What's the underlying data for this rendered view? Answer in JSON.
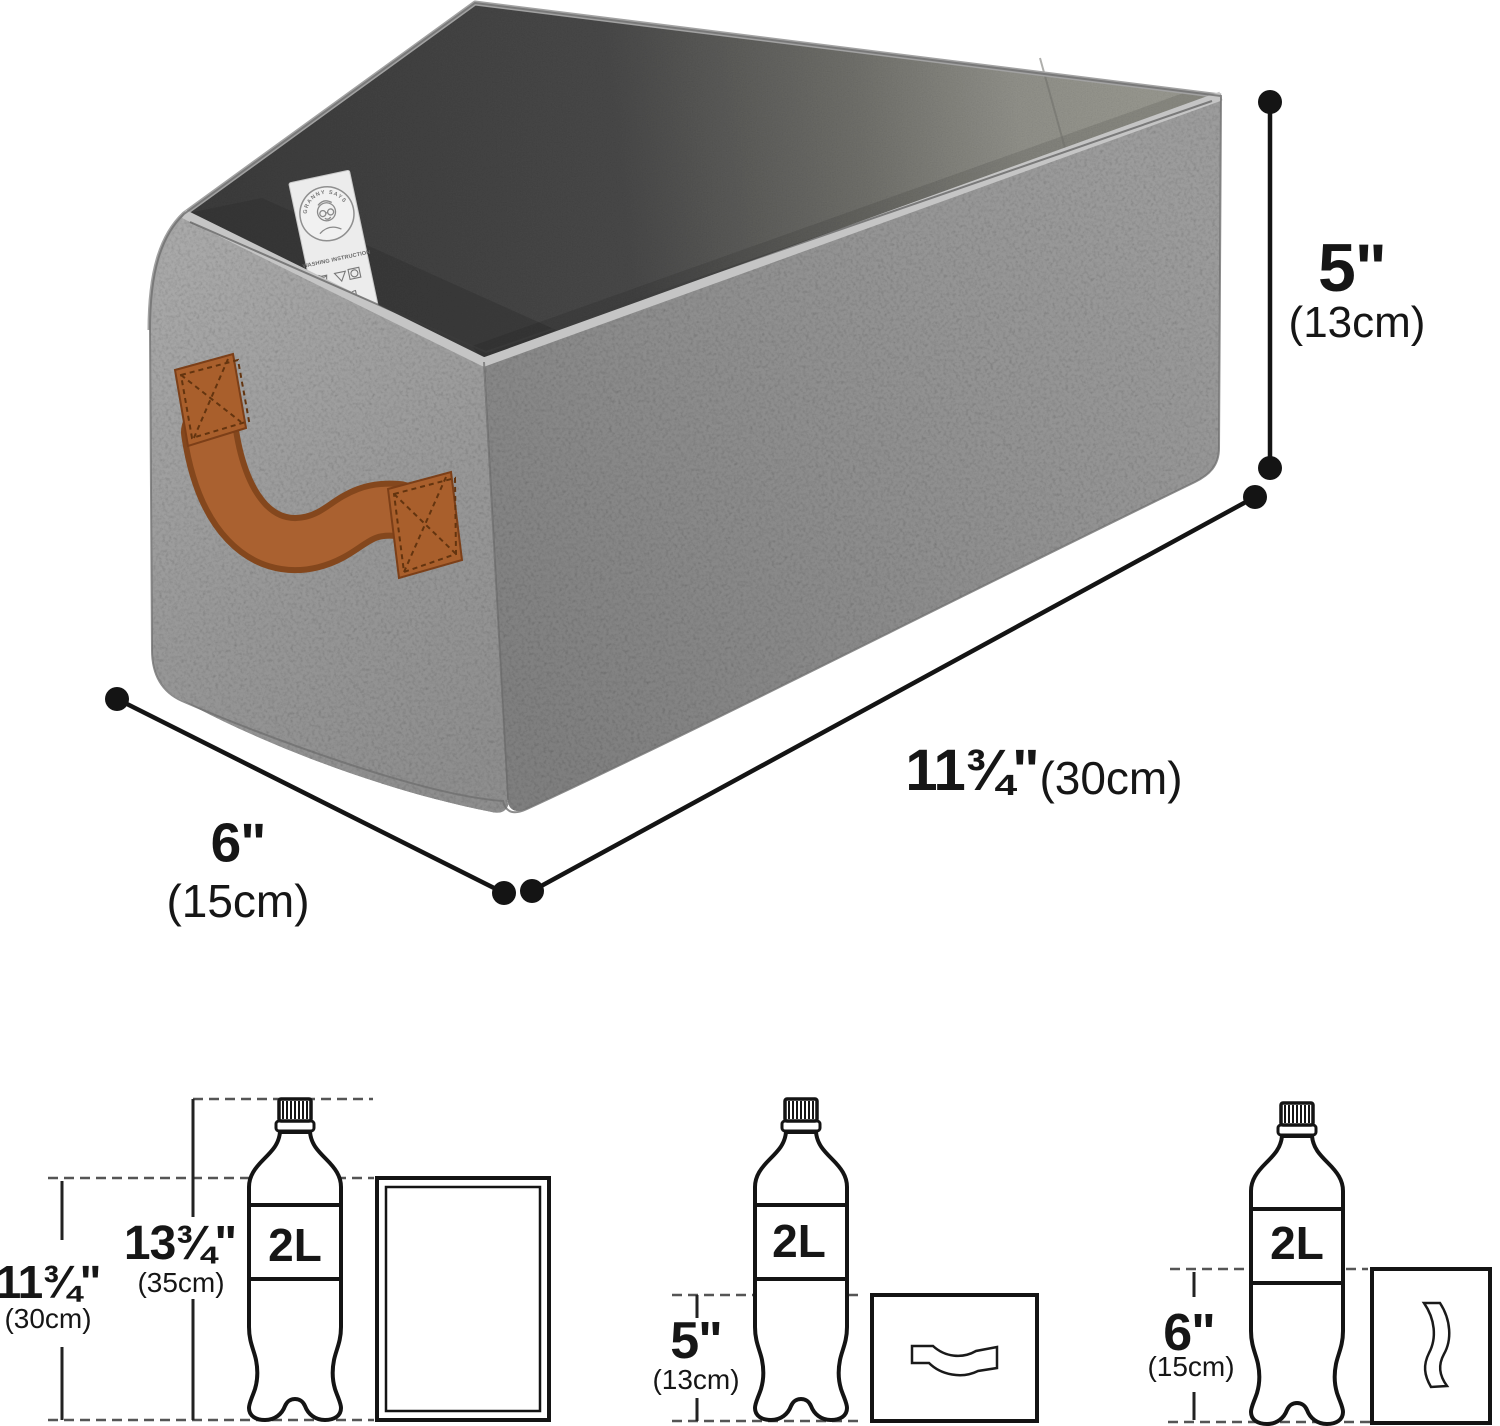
{
  "image_type": "storage-bin-dimension-diagram",
  "brand_tag": {
    "brand": "GRANNY SAYS",
    "text": "WASHING INSTRUCTION"
  },
  "main_dimensions": {
    "height_in": "5\"",
    "height_cm": "(13cm)",
    "length_in": "11¾\"",
    "length_cm": "(30cm)",
    "width_in": "6\"",
    "width_cm": "(15cm)"
  },
  "folded": {
    "panel": {
      "bottle": "2L",
      "height_in": "11¾\"",
      "height_cm": "(30cm)",
      "bottle_height_in": "13¾\"",
      "bottle_height_cm": "(35cm)"
    },
    "flat": {
      "bottle": "2L",
      "height_in": "5\"",
      "height_cm": "(13cm)"
    },
    "side": {
      "bottle": "2L",
      "height_in": "6\"",
      "height_cm": "(15cm)"
    }
  },
  "colors": {
    "fabric": "#8d8d8d",
    "fabric_light": "#a7a7a7",
    "interior_dark": "#3f3f3f",
    "interior_light": "#8f8f88",
    "handle_brown": "#aa6130",
    "line": "#141414"
  }
}
